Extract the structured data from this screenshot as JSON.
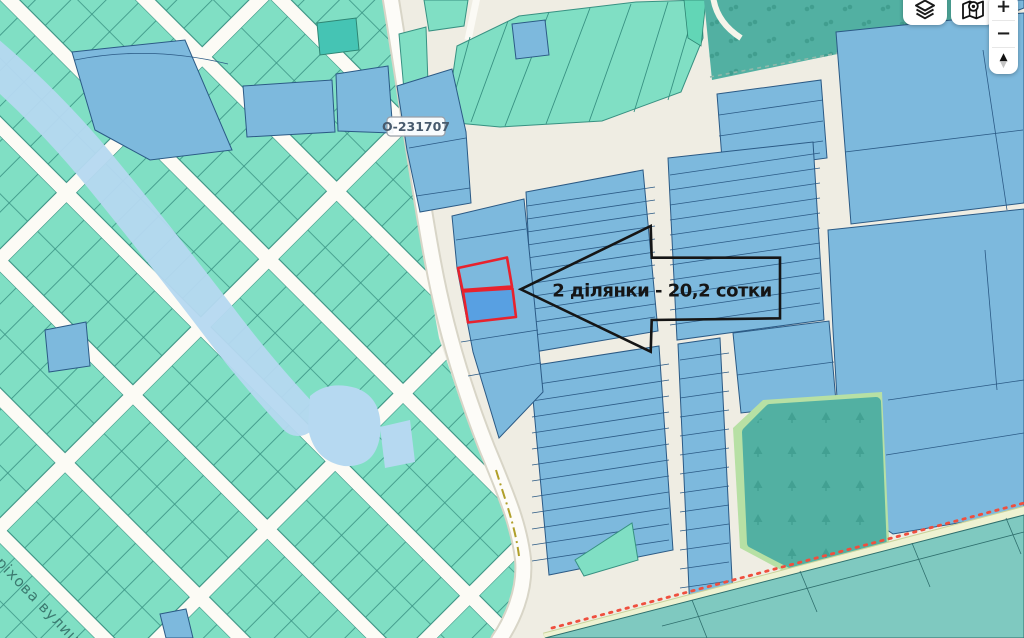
{
  "controls": {
    "layers_button": {
      "icon": "layers-icon"
    },
    "locate_button": {
      "icon": "map-pin-icon"
    },
    "zoom_in_label": "+",
    "zoom_out_label": "−",
    "pan_up_glyph": "▲",
    "pan_down_glyph": "▼"
  },
  "map": {
    "road_label": "О-231707",
    "street_label": "оріхова вулиця",
    "annotation": "2 ділянки - 20,2 сотки",
    "colors": {
      "bg": "#efede3",
      "teal": "#80dfc4",
      "teal_stroke": "#389182",
      "blue": "#7db9dd",
      "blue_stroke": "#2b5a85",
      "selected": "#58a0e2",
      "red": "#e8222d",
      "water": "#b6d9f1",
      "forest": "#52b0a2",
      "cyan": "#7fc9c0",
      "cyan_stroke": "#2f6f6d",
      "annotation": "#151515"
    }
  }
}
